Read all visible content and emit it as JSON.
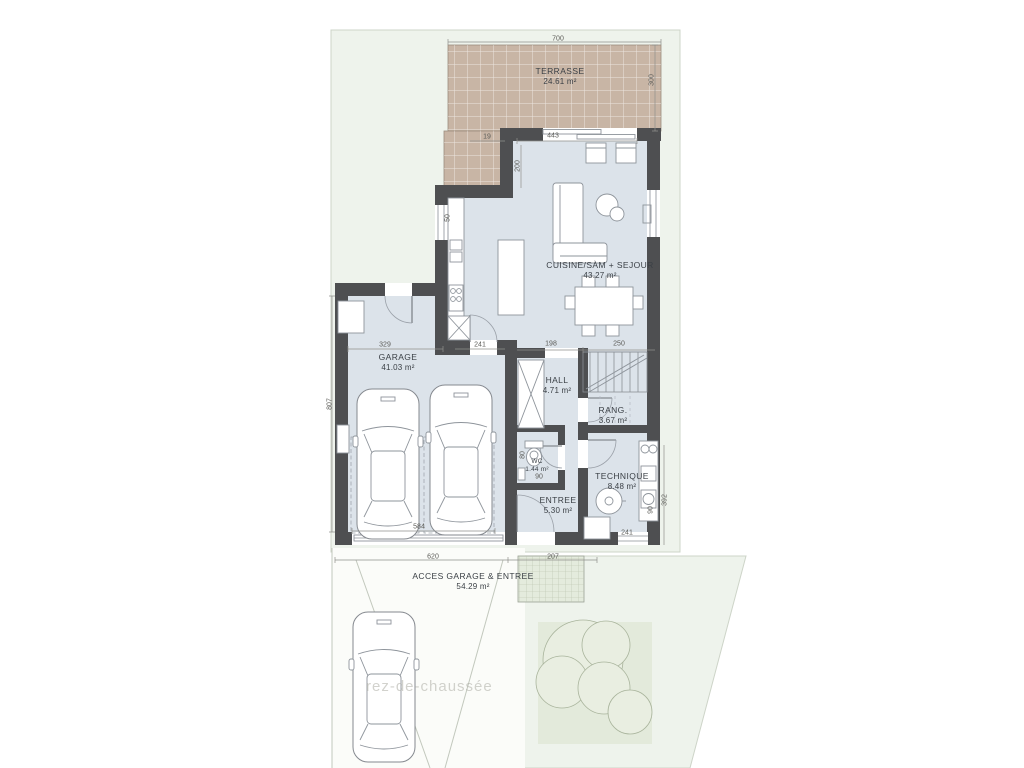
{
  "watermark": "rez-de-chaussée",
  "rooms": {
    "terrasse": {
      "label": "TERRASSE",
      "area": "24.61 m²"
    },
    "cuisine": {
      "label": "CUISINE/SÀM + SEJOUR",
      "area": "43.27 m²"
    },
    "garage": {
      "label": "GARAGE",
      "area": "41.03 m²"
    },
    "hall": {
      "label": "HALL",
      "area": "4.71 m²"
    },
    "rang": {
      "label": "RANG.",
      "area": "3.67 m²"
    },
    "wc": {
      "label": "WC",
      "area": "1.44 m²"
    },
    "entree": {
      "label": "ENTREE",
      "area": "5.30 m²"
    },
    "technique": {
      "label": "TECHNIQUE",
      "area": "8.48 m²"
    },
    "acces": {
      "label": "ACCES GARAGE & ENTREE",
      "area": "54.29 m²"
    }
  },
  "dims": {
    "terrace_width": "700",
    "terrace_depth": "300",
    "terrace_offset": "19",
    "slider": "443",
    "living_left": "200",
    "kitchen_window": "50",
    "garage_width": "329",
    "kitchen_door": "241",
    "hall_width": "198",
    "rang_width": "250",
    "garage_depth": "807",
    "garage_door": "584",
    "wc_width": "80",
    "wc_depth": "90",
    "technique_width": "241",
    "technique_side": "90",
    "technique_depth": "392",
    "driveway_width": "620",
    "entry_width": "207"
  },
  "colors": {
    "wall": "#4e4f51",
    "floor": "#dce3ea",
    "terrace": "#c8b5a5",
    "lawn": "#eef3ec",
    "walkway": "#e4ebdd",
    "tree": "#e9eee1",
    "furniture_line": "#8e949b",
    "dim_text": "#5c5c58",
    "label_text": "#3b4046"
  }
}
